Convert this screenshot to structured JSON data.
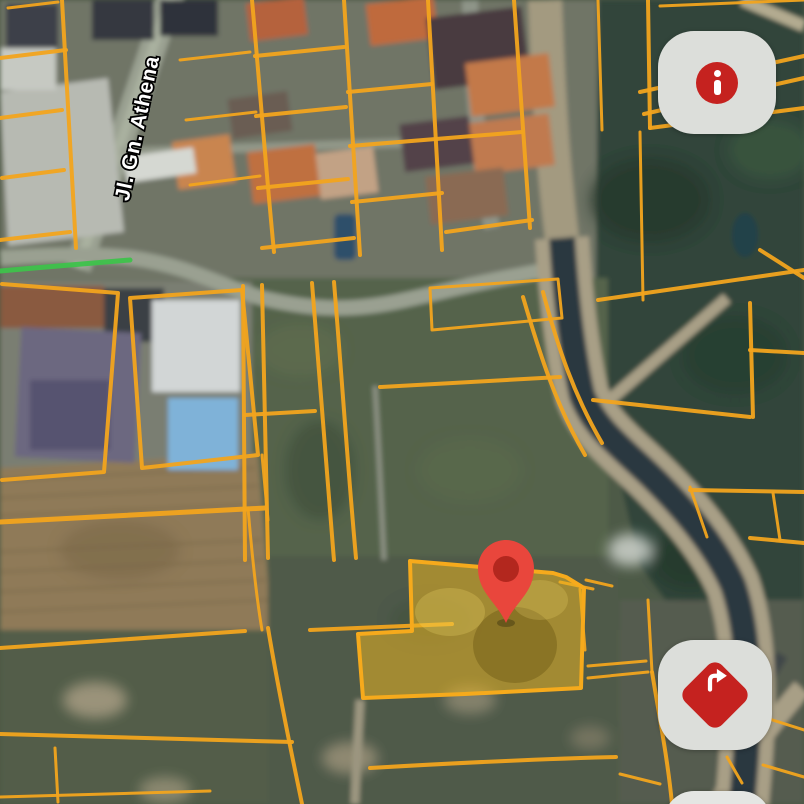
{
  "map": {
    "street_label": "Jl. Gn. Athena"
  },
  "marker": {
    "icon": "map-pin-icon",
    "color": "#E9463C",
    "dot_color": "#B3271E"
  },
  "highlighted_parcel": {
    "fill": "rgba(231,179,33,0.55)",
    "stroke": "#F6AA1C"
  },
  "overlay": {
    "parcel_line_color": "#F2A41E",
    "route_color": "#3EC24B"
  },
  "controls": {
    "info_button": {
      "icon": "info-icon",
      "bg": "#DCDEDA",
      "icon_bg": "#C5221F",
      "icon_fg": "#FFFFFF"
    },
    "directions_button": {
      "icon": "turn-right-icon",
      "bg": "#DCDEDA",
      "icon_bg": "#C5221F",
      "icon_fg": "#FFFFFF"
    }
  }
}
